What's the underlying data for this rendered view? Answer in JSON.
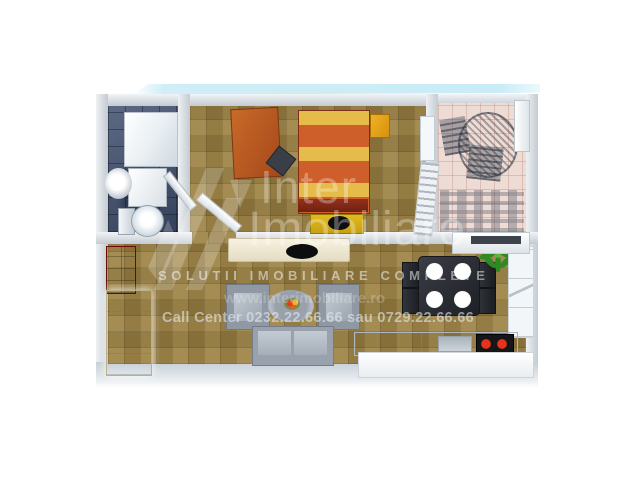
{
  "page": {
    "description": "3D rendered apartment floor plan (real-estate listing image)",
    "background_color": "#ffffff"
  },
  "watermark": {
    "brand_top": "Inter",
    "brand_bottom": "Imobiliare",
    "tagline": "SOLUTII IMOBILIARE COMPLETE",
    "website": "www.interimobiliare.ro",
    "call_center": "Call Center 0232.22.66.66 sau 0729.22.66.66",
    "logo_icon": "diagonal-stripes-roof-mark",
    "text_color": "#ffffff"
  },
  "floorplan": {
    "rooms": [
      {
        "name": "bathroom",
        "floor_color": "#415070",
        "furniture": [
          "shower-cabin",
          "washing-machine",
          "round-sink",
          "toilet",
          "open-door"
        ]
      },
      {
        "name": "bedroom",
        "floor_color": "#9c8142",
        "furniture": [
          "desk",
          "desk-chair",
          "double-bed-orange-yellow-stripes",
          "yellow-nightstand",
          "yellow-tv-bench",
          "radiator",
          "drying-rack",
          "open-door"
        ]
      },
      {
        "name": "balcony",
        "floor_color": "#eedbd4",
        "furniture": [
          "round-mesh-table",
          "two-mesh-chairs",
          "railing-shadow",
          "white-door"
        ]
      },
      {
        "name": "living-kitchen",
        "floor_color": "#9c8142",
        "furniture": [
          "red-wall-cabinet",
          "tall-wardrobe",
          "tv-stand-with-tv",
          "two-armchairs",
          "round-coffee-table-with-flowers",
          "sofa",
          "dining-table-four-plates",
          "four-chairs",
          "green-plant",
          "shelf-unit",
          "upper-cabinet",
          "kitchen-counter",
          "sink",
          "stove-two-red-burners"
        ]
      }
    ],
    "accent_colors": {
      "bed_orange": "#cf5f2a",
      "bed_yellow": "#e5bb4a",
      "red_cabinet": "#b51208",
      "stove_burners": "#e8321c",
      "plant_green": "#2f8a22",
      "roof_band_cyan": "#cfeef7"
    }
  }
}
